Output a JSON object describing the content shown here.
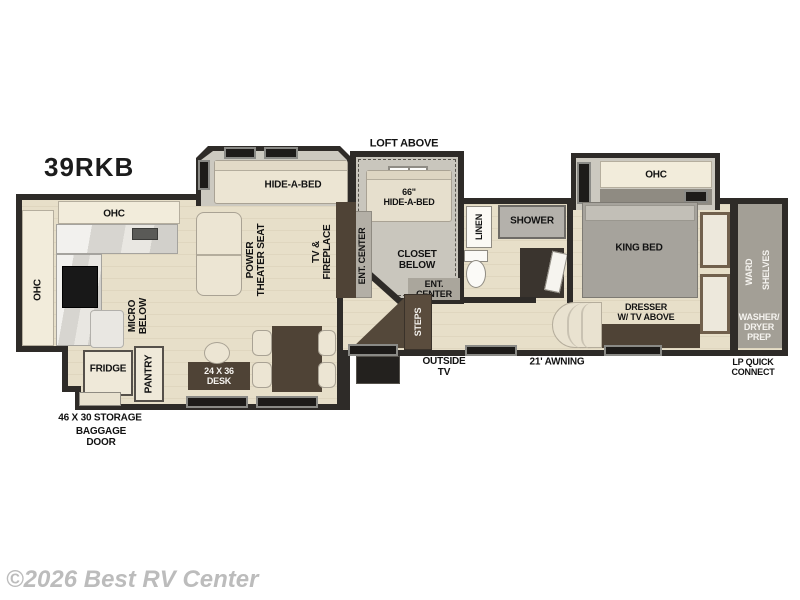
{
  "page": {
    "title": "39RKB",
    "watermark": "©2026 Best RV Center"
  },
  "exterior": {
    "loft_above": "LOFT ABOVE",
    "storage": "46 X 30 STORAGE",
    "baggage_door": "BAGGAGE\nDOOR",
    "outside_tv": "OUTSIDE\nTV",
    "awning": "21' AWNING",
    "lp_quick_connect": "LP QUICK\nCONNECT"
  },
  "kitchen": {
    "ohc_top": "OHC",
    "ohc_left": "OHC",
    "micro": "MICRO\nBELOW",
    "fridge": "FRIDGE",
    "pantry": "PANTRY",
    "desk": "24 X 36\nDESK"
  },
  "living": {
    "hide_a_bed": "HIDE-A-BED",
    "theater_seat": "POWER\nTHEATER SEAT",
    "tv_fireplace": "TV &\nFIREPLACE"
  },
  "loft": {
    "loft_label": "LOFT ABOVE",
    "ent_center_side": "ENT. CENTER",
    "hide_a_bed": "66\"\nHIDE-A-BED",
    "closet_below": "CLOSET\nBELOW",
    "ent_center": "ENT.\nCENTER",
    "steps": "STEPS"
  },
  "bath": {
    "linen": "LINEN",
    "shower": "SHOWER"
  },
  "bedroom": {
    "ohc": "OHC",
    "king_bed": "KING BED",
    "dresser": "DRESSER\nW/ TV ABOVE"
  },
  "rear": {
    "ward": "WARD",
    "shelves": "SHELVES",
    "washer": "WASHER/\nDRYER\nPREP"
  },
  "colors": {
    "wall": "#2e2b28",
    "floor": "#e7dfc9",
    "slide_floor": "#ccc9c0",
    "furniture_brown": "#4f4336",
    "furniture_cream": "#ece5d3",
    "label": "#121212",
    "watermark": "#bcbcbc"
  }
}
